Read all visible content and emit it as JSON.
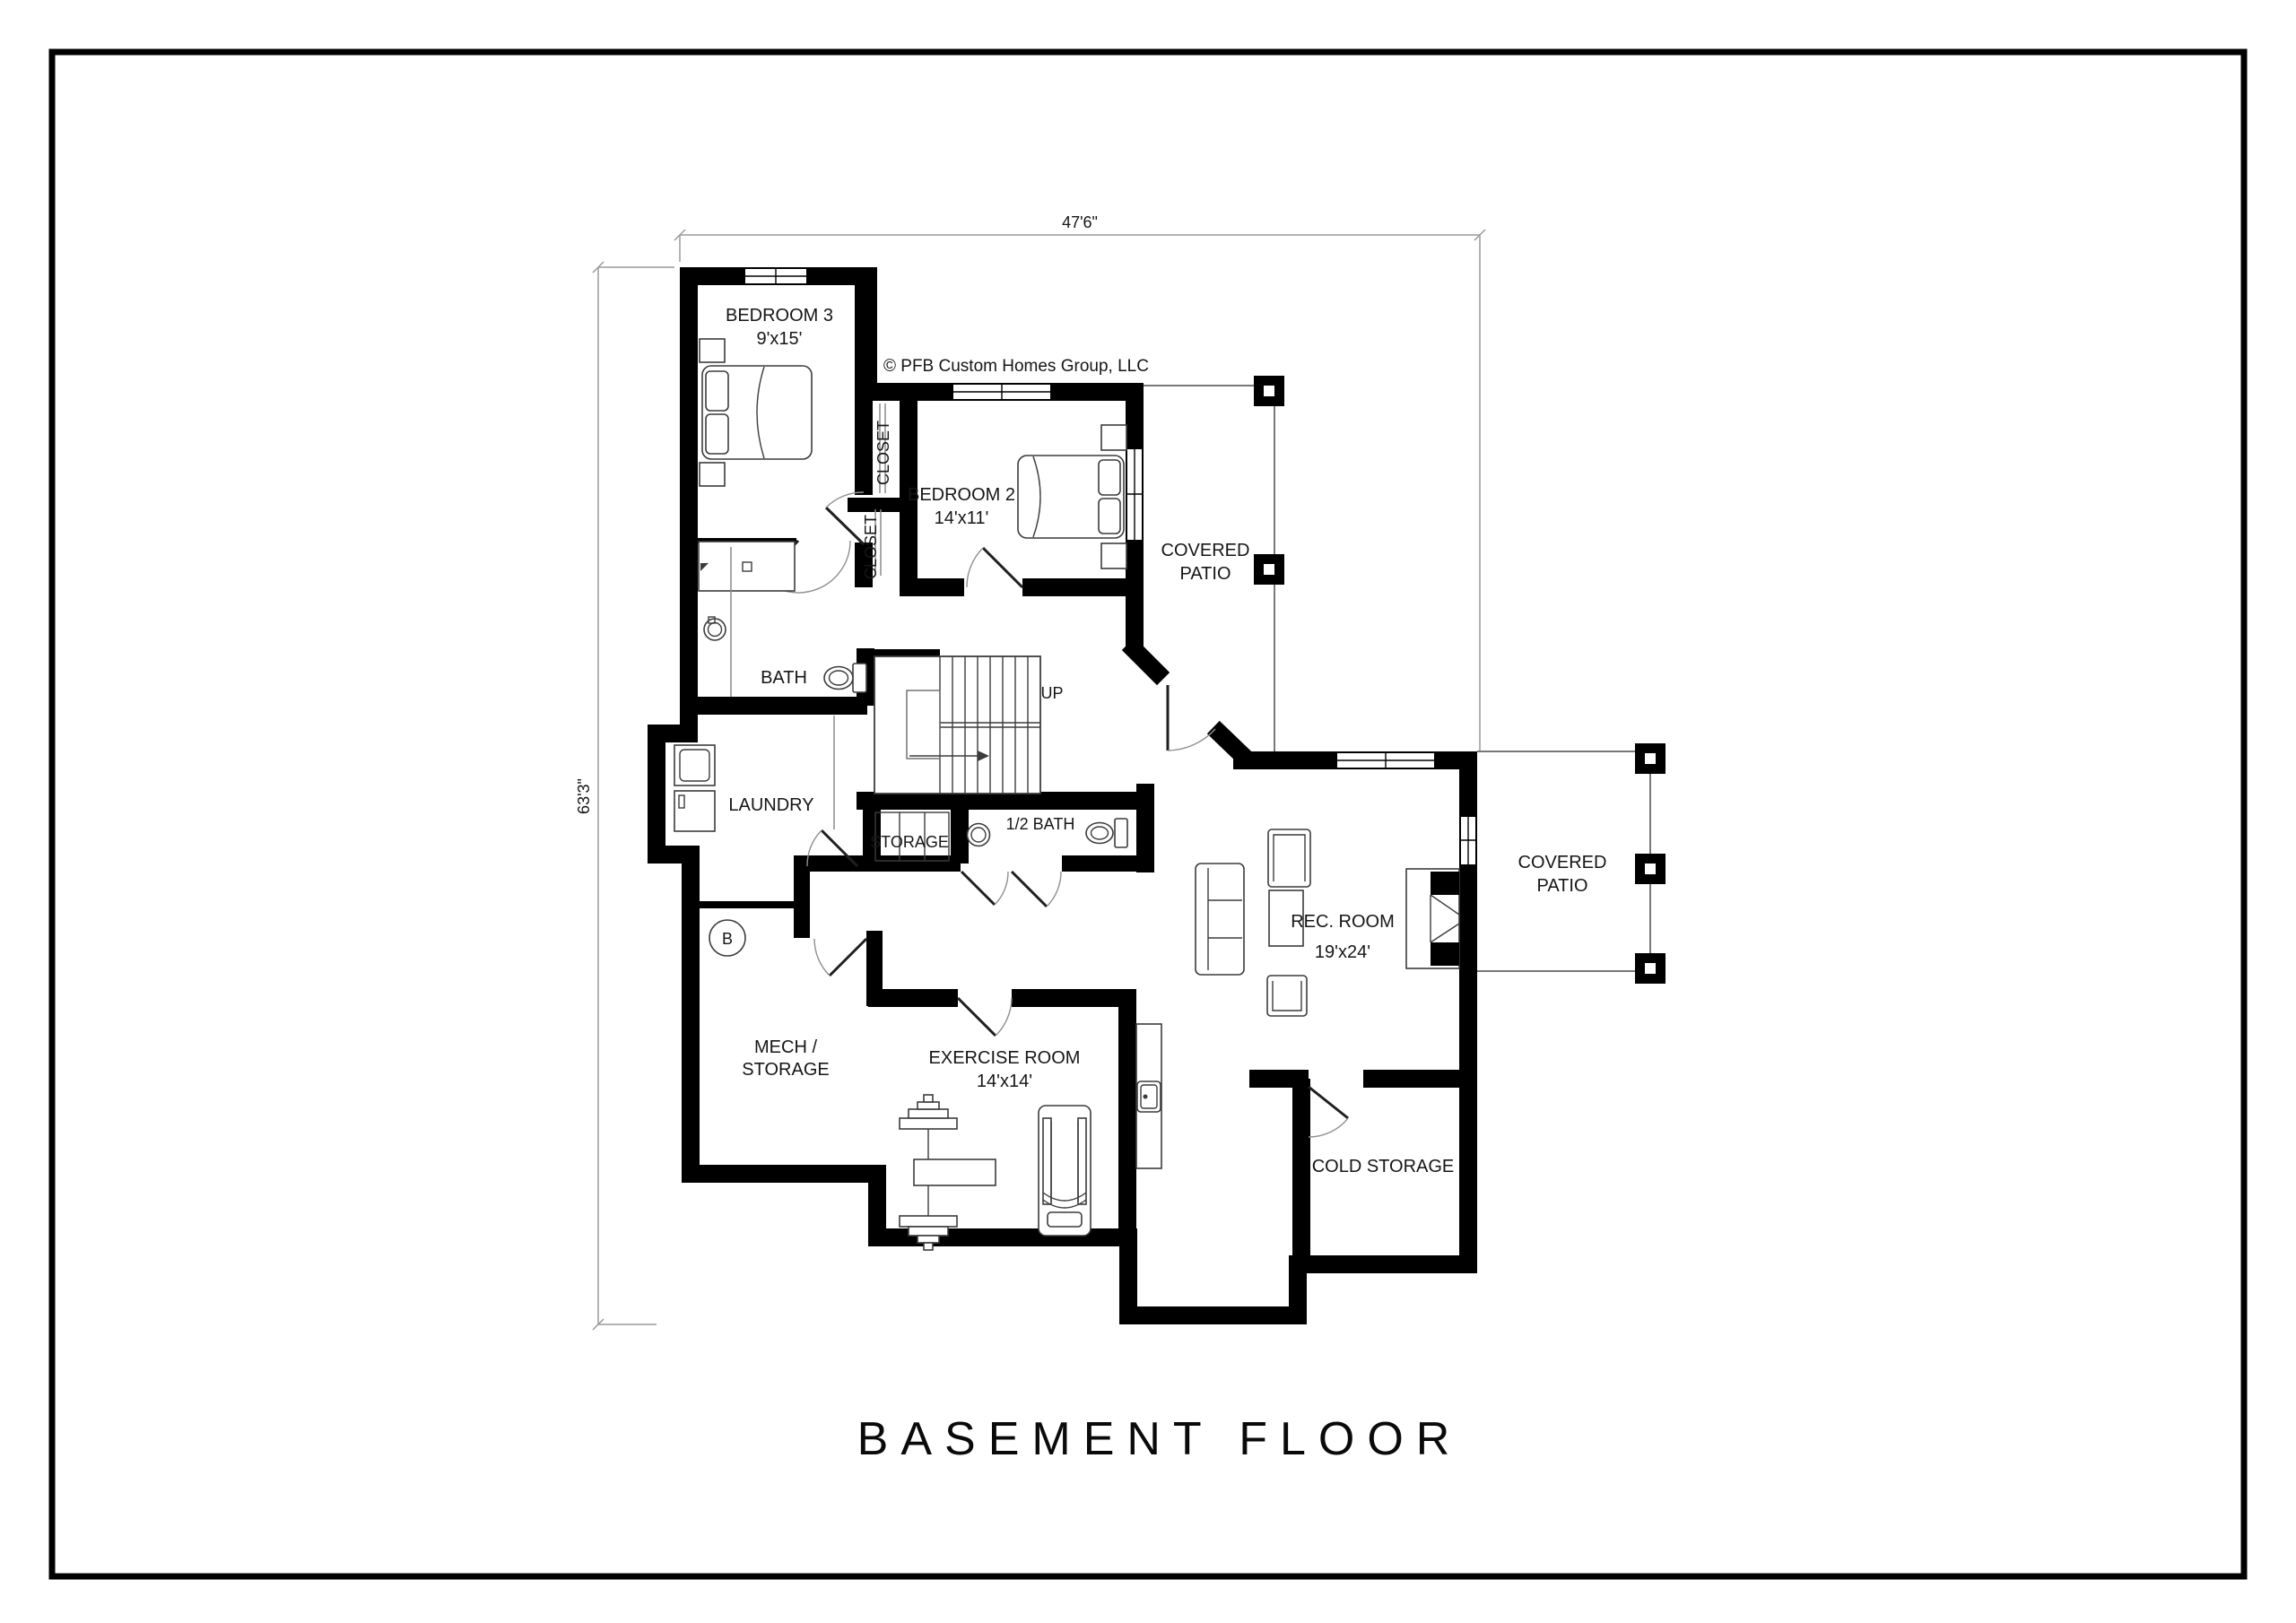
{
  "page": {
    "background": "#ffffff",
    "border_color": "#000000",
    "wall_color": "#000000",
    "line_color": "#8a8a8a"
  },
  "title": "BASEMENT FLOOR",
  "copyright": "© PFB Custom Homes Group, LLC",
  "dims": {
    "overall_width": "47'6\"",
    "overall_height": "63'3\""
  },
  "rooms": {
    "bedroom3": {
      "name": "BEDROOM 3",
      "size": "9'x15'"
    },
    "bedroom2": {
      "name": "BEDROOM 2",
      "size": "14'x11'"
    },
    "closet_upper": {
      "name": "CLOSET"
    },
    "closet_lower": {
      "name": "CLOSET"
    },
    "bath": {
      "name": "BATH"
    },
    "laundry": {
      "name": "LAUNDRY"
    },
    "storage": {
      "name": "STORAGE"
    },
    "half_bath": {
      "name": "1/2 BATH"
    },
    "rec_room": {
      "name": "REC. ROOM",
      "size": "19'x24'"
    },
    "mech": {
      "line1": "MECH /",
      "line2": "STORAGE"
    },
    "exercise": {
      "name": "EXERCISE ROOM",
      "size": "14'x14'"
    },
    "cold_storage": {
      "name": "COLD STORAGE"
    },
    "patio_upper": {
      "line1": "COVERED",
      "line2": "PATIO"
    },
    "patio_right": {
      "line1": "COVERED",
      "line2": "PATIO"
    }
  },
  "stairs": {
    "label": "UP"
  },
  "markers": {
    "b_circle": "B"
  }
}
